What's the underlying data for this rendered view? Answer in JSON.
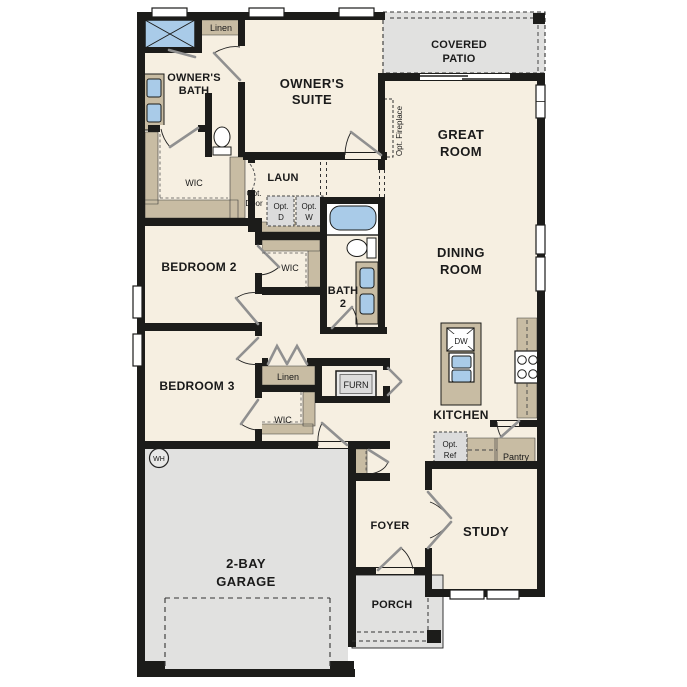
{
  "plan": {
    "colors": {
      "wall": "#1c1c1a",
      "floor": "#f6efe1",
      "outdoor": "#e1e1e0",
      "tan": "#c8bca3",
      "blue": "#a9cbe8",
      "appliance": "#dcdcdc",
      "ink": "#1a1a1a"
    },
    "labels": {
      "owners_suite_1": "OWNER'S",
      "owners_suite_2": "SUITE",
      "owners_bath_1": "OWNER'S",
      "owners_bath_2": "BATH",
      "covered_patio_1": "COVERED",
      "covered_patio_2": "PATIO",
      "great_room_1": "GREAT",
      "great_room_2": "ROOM",
      "dining_room_1": "DINING",
      "dining_room_2": "ROOM",
      "garage_1": "2-BAY",
      "garage_2": "GARAGE",
      "bath2_1": "BATH",
      "bath2_2": "2",
      "bedroom2": "BEDROOM 2",
      "bedroom3": "BEDROOM 3",
      "kitchen": "KITCHEN",
      "foyer": "FOYER",
      "study": "STUDY",
      "porch": "PORCH",
      "laun": "LAUN",
      "linen_top": "Linen",
      "linen_hall": "Linen",
      "wic_owner": "WIC",
      "wic_bed2": "WIC",
      "wic_bed3": "WIC",
      "pantry": "Pantry",
      "dw": "DW",
      "furn": "FURN",
      "wh": "WH",
      "opt_fireplace": "Opt. Fireplace",
      "opt_door_1": "Opt.",
      "opt_door_2": "Door",
      "opt_d_1": "Opt.",
      "opt_d_2": "D",
      "opt_w_1": "Opt.",
      "opt_w_2": "W",
      "opt_ref_1": "Opt.",
      "opt_ref_2": "Ref"
    }
  }
}
